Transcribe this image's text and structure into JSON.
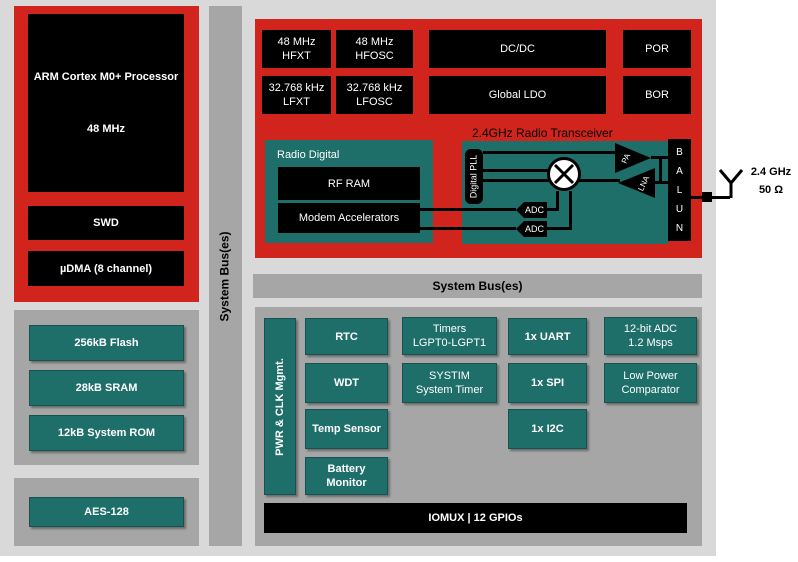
{
  "colors": {
    "red": "#d0241c",
    "teal": "#1e6e6a",
    "container_gray": "#a6a6a6",
    "background_gray": "#d9d9d9",
    "block_black": "#000000",
    "text_white": "#ffffff"
  },
  "cpu": {
    "processor_title": "ARM Cortex M0+ Processor",
    "processor_speed": "48 MHz",
    "swd": "SWD",
    "udma": "µDMA (8 channel)"
  },
  "memory": {
    "flash": "256kB Flash",
    "sram": "28kB SRAM",
    "rom": "12kB System ROM"
  },
  "security": {
    "aes": "AES-128"
  },
  "buses": {
    "vertical": "System Bus(es)",
    "horizontal": "System Bus(es)"
  },
  "clocks_power": {
    "hfxt": "48 MHz\nHFXT",
    "hfosc": "48 MHz\nHFOSC",
    "dcdc": "DC/DC",
    "por": "POR",
    "lfxt": "32.768 kHz\nLFXT",
    "lfosc": "32.768 kHz\nLFOSC",
    "ldo": "Global LDO",
    "bor": "BOR"
  },
  "radio": {
    "digital_title": "Radio Digital",
    "rf_ram": "RF RAM",
    "modem": "Modem Accelerators",
    "transceiver_title": "2.4GHz Radio Transceiver",
    "pll": "Digital PLL",
    "adc_top": "ADC",
    "adc_bottom": "ADC",
    "pa": "PA",
    "lna": "LNA",
    "balun": "B\nA\nL\nU\nN",
    "antenna_freq": "2.4 GHz",
    "antenna_impedance": "50 Ω"
  },
  "peripherals": {
    "pwr_clk": "PWR & CLK Mgmt.",
    "rtc": "RTC",
    "wdt": "WDT",
    "temp_sensor": "Temp Sensor",
    "battery": "Battery\nMonitor",
    "timers": "Timers\nLGPT0-LGPT1",
    "systim": "SYSTIM\nSystem Timer",
    "uart": "1x UART",
    "spi": "1x SPI",
    "i2c": "1x I2C",
    "adc": "12-bit ADC\n1.2 Msps",
    "comparator": "Low Power\nComparator",
    "iomux": "IOMUX | 12 GPIOs"
  }
}
